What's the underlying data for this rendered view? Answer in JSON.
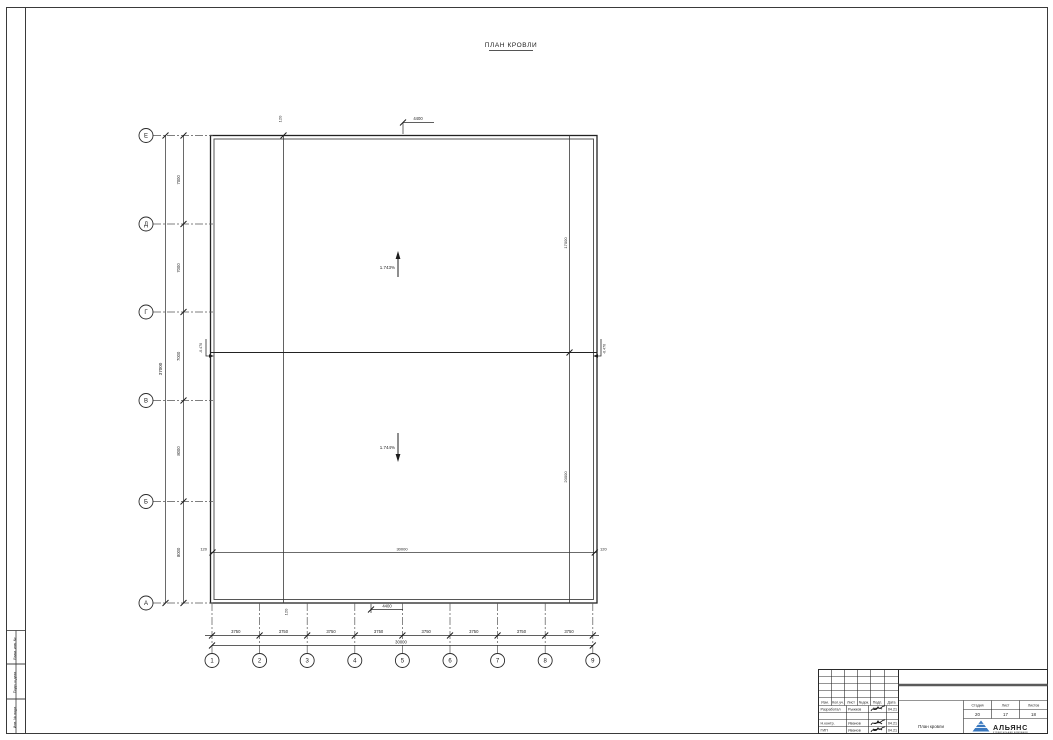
{
  "sheet": {
    "title": "ПЛАН КРОВЛИ"
  },
  "axes": {
    "rows": [
      "Е",
      "Д",
      "Г",
      "В",
      "Б",
      "А"
    ],
    "cols": [
      "1",
      "2",
      "3",
      "4",
      "5",
      "6",
      "7",
      "8",
      "9"
    ]
  },
  "dims": {
    "row_spacing": [
      "7000",
      "7000",
      "7000",
      "8000",
      "8000"
    ],
    "row_total": "37000",
    "col_spacing": [
      "3750",
      "3750",
      "3750",
      "3750",
      "3750",
      "3750",
      "3750",
      "3750"
    ],
    "col_total": "30000",
    "top_parapet": "120",
    "top_offset": "4400",
    "bottom_parapet": "120",
    "bottom_offset": "4400",
    "inner_bottom_left": "120",
    "inner_bottom_total": "30000",
    "inner_bottom_right": "120",
    "inner_right_upper": "17000",
    "inner_right_lower": "20000"
  },
  "slopes": {
    "upper": "1.743%",
    "lower": "1.744%"
  },
  "valley": {
    "left_mark": "-0.470",
    "right_mark": "-0.470"
  },
  "side_strip": {
    "labels": [
      "Взам. инв. №",
      "Подп. и дата",
      "Инв. № подл."
    ]
  },
  "stamp": {
    "change_headers": [
      "Изм.",
      "Кол.уч.",
      "Лист",
      "№док.",
      "Подп.",
      "Дата"
    ],
    "rows": [
      {
        "role": "Разработал",
        "name": "Рыжков",
        "date": "04.21"
      },
      {
        "role": "",
        "name": "",
        "date": ""
      },
      {
        "role": "Н.контр.",
        "name": "Иванов",
        "date": "04.21"
      },
      {
        "role": "ГИП",
        "name": "Иванов",
        "date": "04.21"
      }
    ],
    "doc_title": "План кровли",
    "meta_headers": [
      "Стадия",
      "Лист",
      "Листов"
    ],
    "meta_values": [
      "20",
      "17",
      "18"
    ],
    "org": {
      "name": "АЛЬЯНС",
      "subtitle": "строительная компания"
    }
  },
  "colors": {
    "line": "#2a2a2a",
    "accent_blue": "#1f5fa8",
    "logo_blue": "#3a78bf"
  }
}
